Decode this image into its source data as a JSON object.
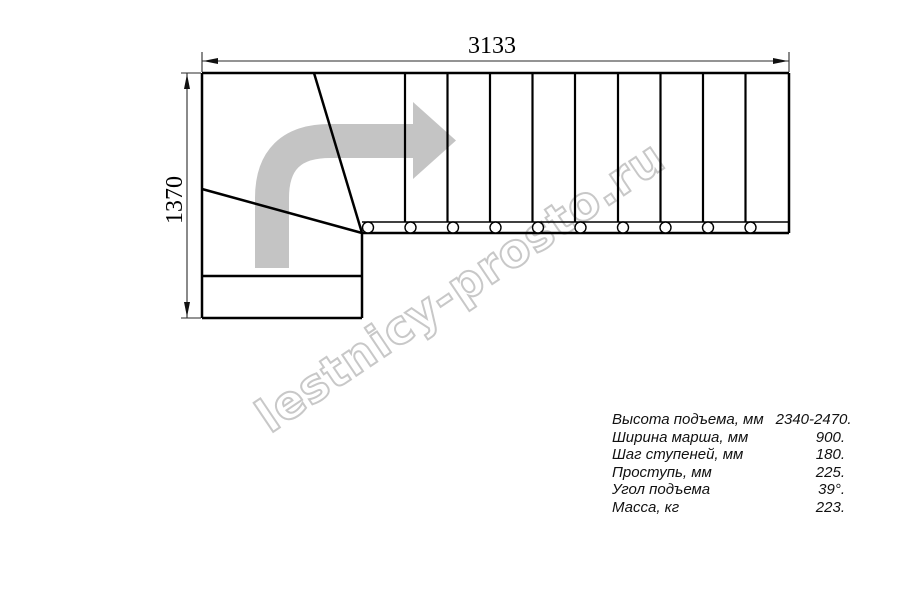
{
  "drawing": {
    "dimension_width_label": "3133",
    "dimension_height_label": "1370",
    "watermark_text": "lestnicy-prosto.ru",
    "arrow_color": "#c4c4c4",
    "watermark_color": "#c8c8c8",
    "line_color": "#000000",
    "stair_plan": {
      "straight_tread_count": 10,
      "baluster_count": 10,
      "winder_tread_count": 3
    }
  },
  "specs": {
    "rows": [
      {
        "label": "Высота подъема, мм",
        "value": "2340-2470."
      },
      {
        "label": "Ширина марша, мм",
        "value": "900."
      },
      {
        "label": "Шаг ступеней, мм",
        "value": "180."
      },
      {
        "label": "Проступь, мм",
        "value": "225."
      },
      {
        "label": "Угол подъема",
        "value": "39°."
      },
      {
        "label": "Масса, кг",
        "value": "223."
      }
    ]
  }
}
